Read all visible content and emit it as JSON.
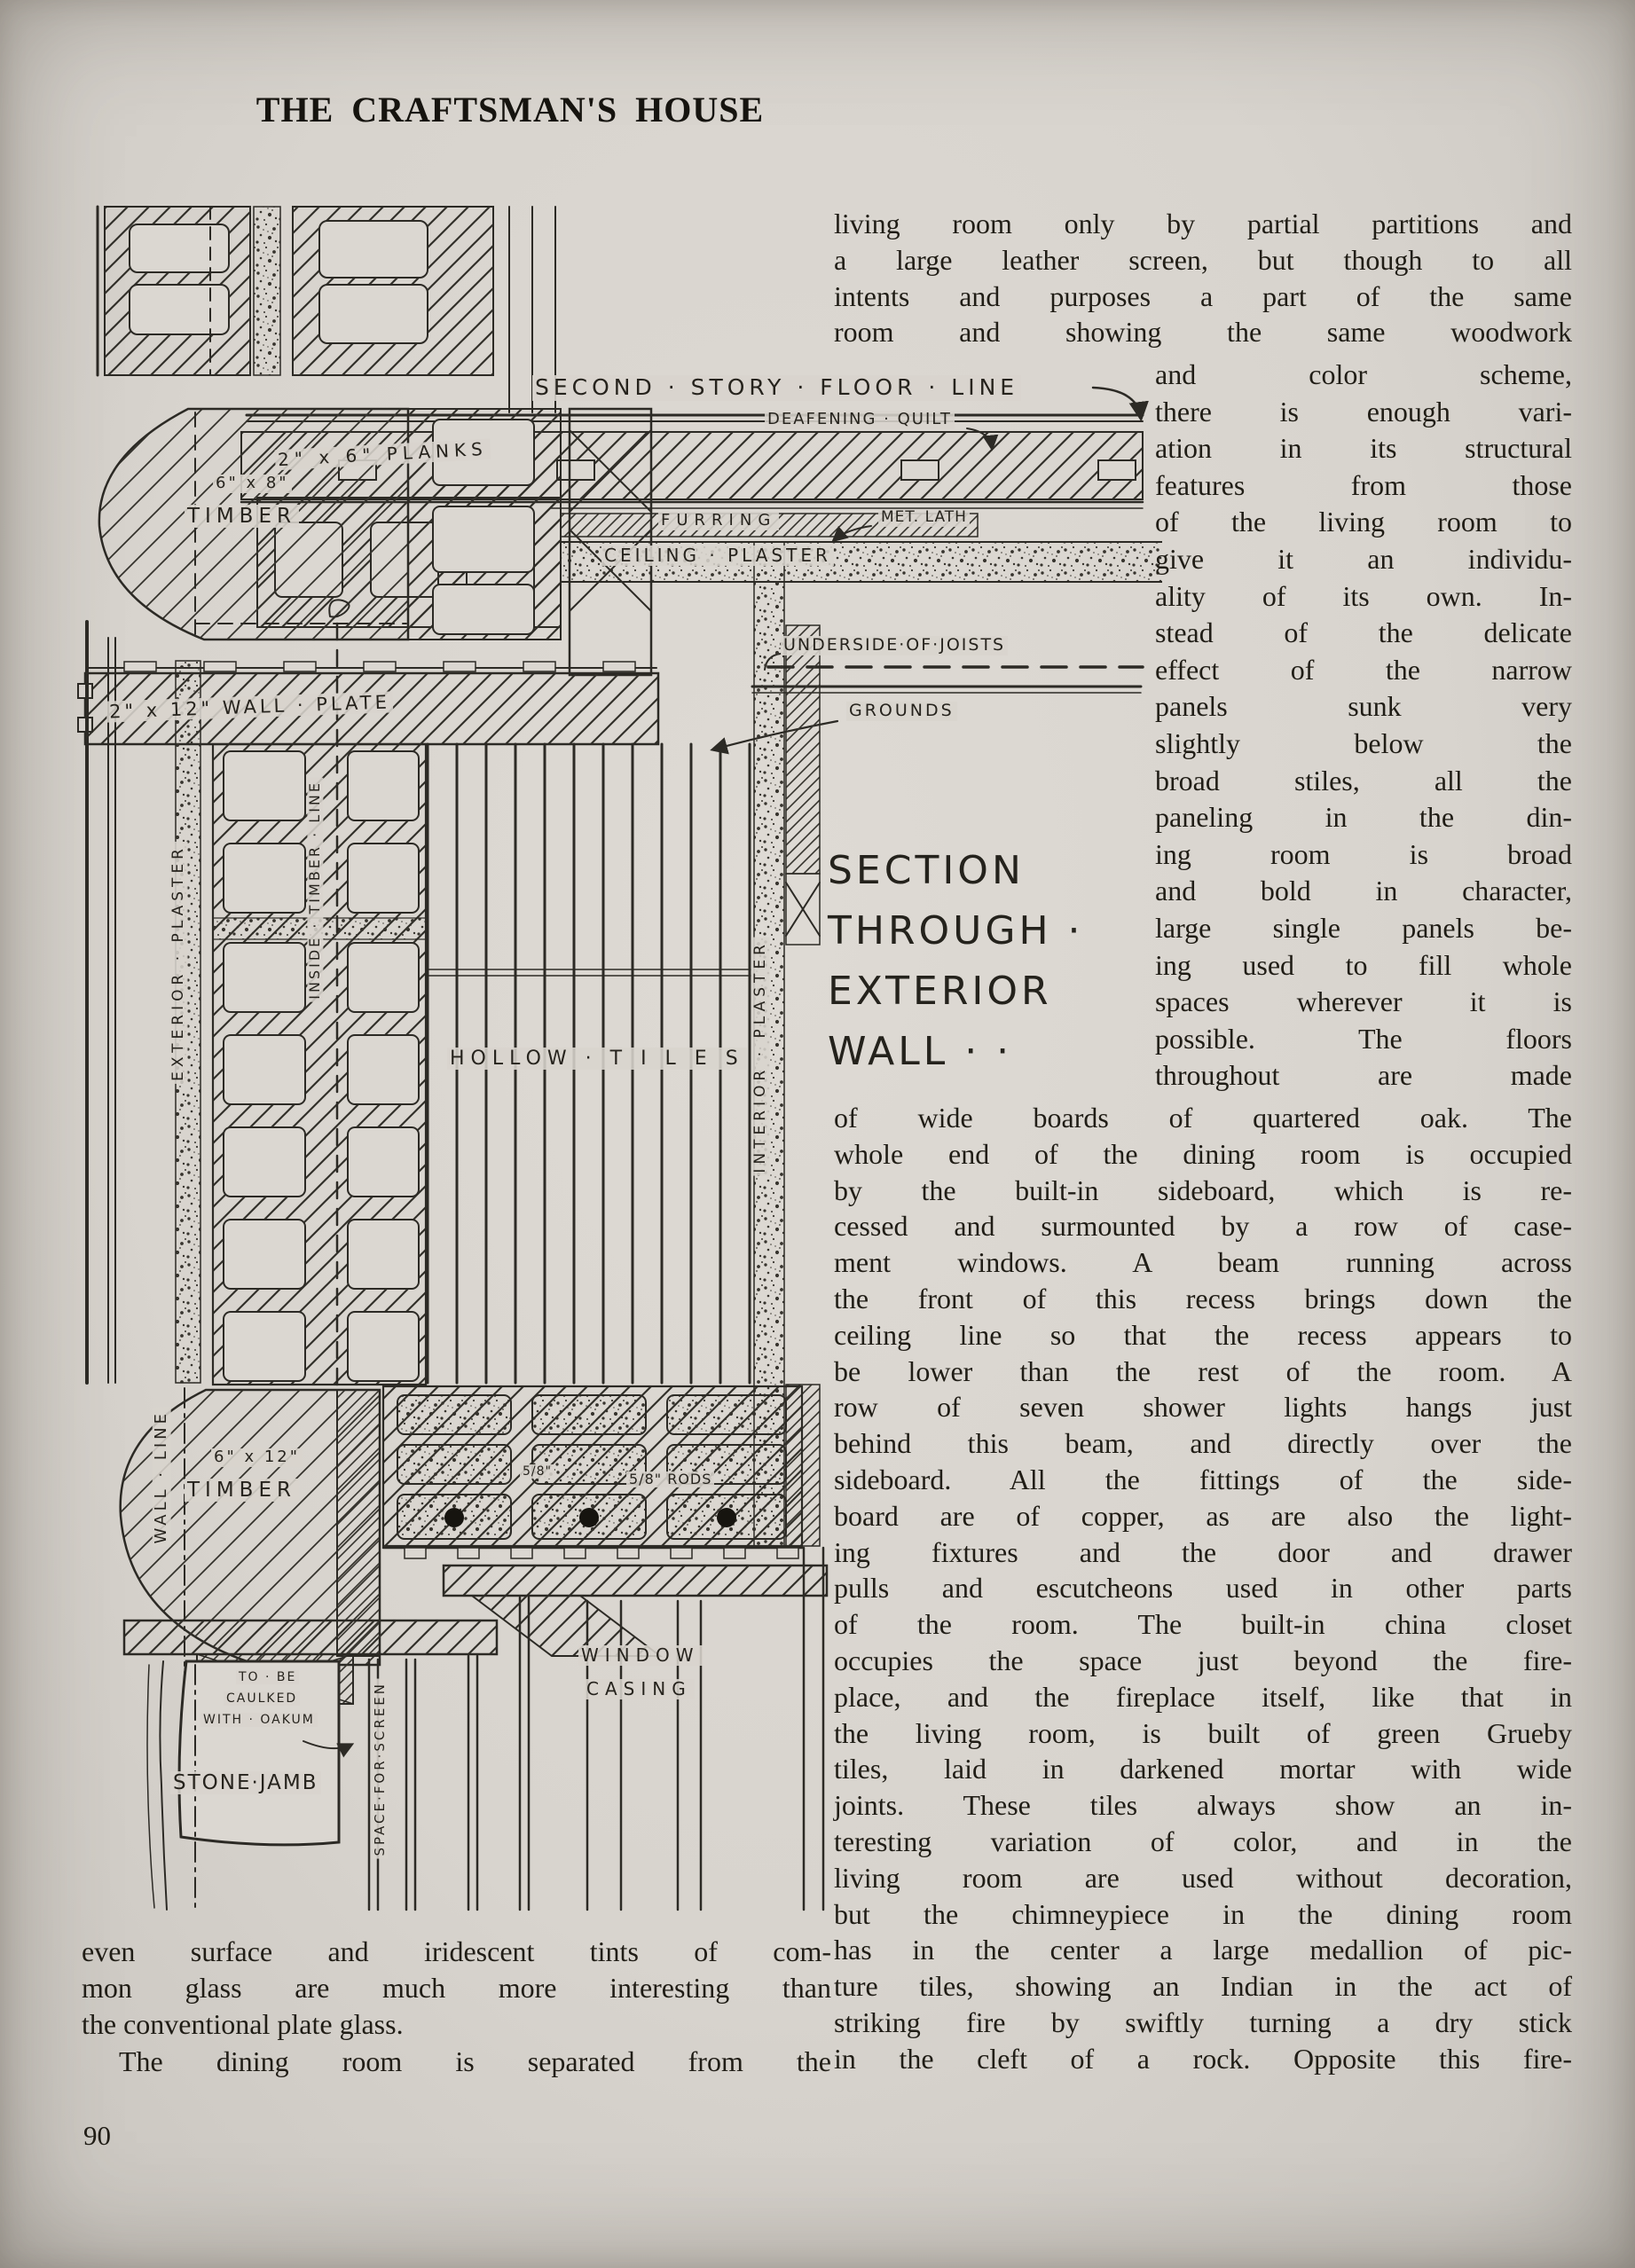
{
  "page": {
    "title": "THE CRAFTSMAN'S HOUSE",
    "number": "90"
  },
  "heading": {
    "lines": [
      "SECTION",
      "THROUGH ·",
      "EXTERIOR",
      "WALL · ·"
    ]
  },
  "columns": {
    "right_top": {
      "lines": [
        "living room only by partial partitions and",
        "a large leather screen, but though to all",
        "intents and purposes a part of the same",
        "room and showing the same woodwork"
      ]
    },
    "right_narrow": {
      "lines": [
        "and color scheme,",
        "there is enough vari-",
        "ation in its structural",
        "features from those",
        "of the living room to",
        "give it an individu-",
        "ality of its own.  In-",
        "stead of the delicate",
        "effect of the narrow",
        "panels sunk very",
        "slightly below the",
        "broad stiles, all the",
        "paneling in the din-",
        "ing room is broad",
        "and bold in character,",
        "large single panels be-",
        "ing used to fill whole",
        "spaces wherever it is",
        "possible.   The   floors",
        "throughout are made"
      ]
    },
    "right_wide": {
      "lines": [
        "of wide boards of quartered oak.  The",
        "whole end of the dining room is occupied",
        "by the built-in sideboard, which is re-",
        "cessed and surmounted by a row of case-",
        "ment windows.  A beam running across",
        "the front of this recess brings down the",
        "ceiling line so that the recess appears to",
        "be lower than the rest of the room.  A",
        "row of seven shower lights hangs just",
        "behind this beam, and directly over the",
        "sideboard.  All the fittings of the side-",
        "board are of copper, as are also the light-",
        "ing fixtures and the door and drawer",
        "pulls and escutcheons used in other parts",
        "of the room.  The built-in china closet",
        "occupies the space just beyond the fire-",
        "place, and the fireplace itself, like that in",
        "the living room, is built of green Grueby",
        "tiles, laid in darkened mortar with wide",
        "joints.  These tiles always show an in-",
        "teresting variation of color, and in the",
        "living room are used without decoration,",
        "but the chimneypiece in the dining room",
        "has in the center a large medallion of pic-",
        "ture tiles, showing an Indian in the act of",
        "striking fire by swiftly turning a dry stick",
        "in the cleft of a rock.  Opposite this fire-"
      ]
    },
    "bottom_left": {
      "lines": [
        "even surface and iridescent tints of com-",
        "mon glass are much more interesting than",
        "the conventional plate glass.",
        "The dining room is separated from the"
      ],
      "ragged": [
        2
      ],
      "indent": [
        3
      ]
    }
  },
  "drawing": {
    "labels": {
      "floor_line": "SECOND · STORY · FLOOR · LINE",
      "deafening_quilt": "DEAFENING · QUILT",
      "planks": "2\" x 6\" PLANKS",
      "furring": "FURRING",
      "met_lath": "MET. LATH",
      "ceiling_plaster": "CEILING · PLASTER",
      "underside_of_joists": "UNDERSIDE·OF·JOISTS",
      "grounds": "GROUNDS",
      "wall_plate": "2\" x 12\" WALL · PLATE",
      "timber_6x8_size": "6\" x 8\"",
      "timber_6x8": "TIMBER",
      "exterior_plaster": "EXTERIOR · PLASTER",
      "inside_timber_line": "INSIDE · TIMBER · LINE",
      "hollow_tiles": "HOLLOW · T I L E S",
      "interior_plaster": "INTERIOR · PLASTER",
      "wall_line": "WALL · LINE",
      "timber_6x12_size": "6\" x 12\"",
      "timber_6x12": "TIMBER",
      "rod_size": "5/8\"",
      "rods": "5/8\" RODS",
      "window_casing_line1": "WINDOW",
      "window_casing_line2": "CASING",
      "caulked_line1": "TO · BE",
      "caulked_line2": "CAULKED",
      "caulked_line3": "WITH · OAKUM",
      "stone_jamb": "STONE·JAMB",
      "space_for_screen": "SPACE·FOR·SCREEN"
    }
  }
}
